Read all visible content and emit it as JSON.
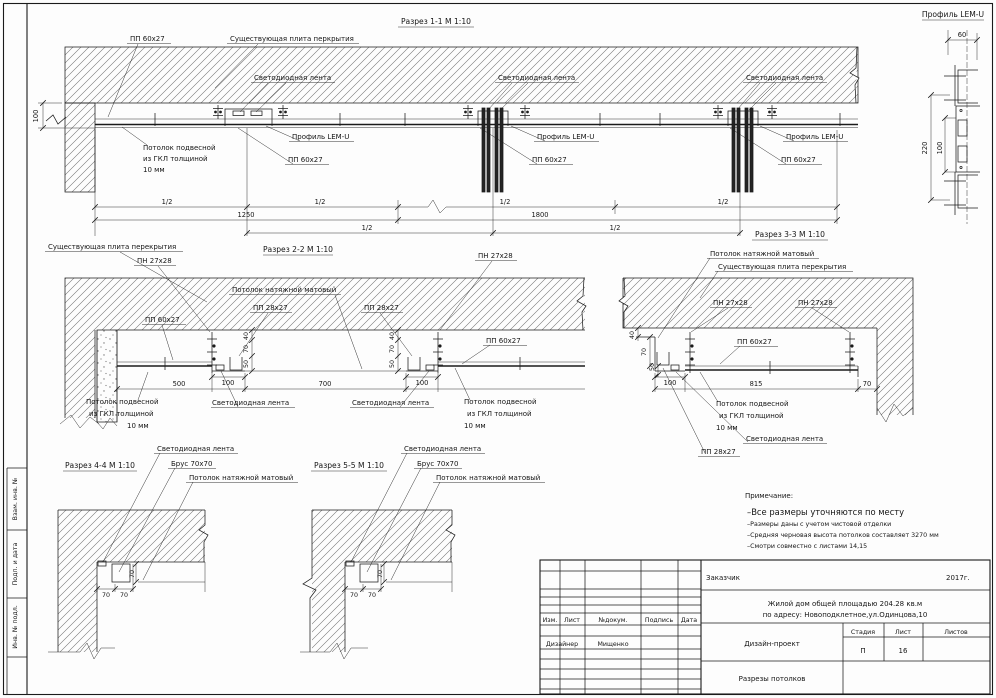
{
  "sheet": {
    "side_labels": [
      "Взам. инв. №",
      "Подп. и дата",
      "Инв. № подл."
    ]
  },
  "common": {
    "led": "Светодиодная лента",
    "lemu": "Профиль LEM-U",
    "pp60": "ПП 60х27",
    "pp28": "ПП 28х27",
    "pn27": "ПН 27х28",
    "slab": "Существующая плита перекрытия",
    "slab_s11": "Существующая плита перкрытия",
    "stretch": "Потолок натяжной матовый",
    "gkl1": "Потолок подвесной",
    "gkl2": "из ГКЛ толщиной",
    "gkl3": "10 мм",
    "brus": "Брус 70х70",
    "half": "1/2"
  },
  "sections": {
    "s11": {
      "title": "Разрез 1-1 М 1:10",
      "d100": "100",
      "d1250": "1250",
      "d1800": "1800"
    },
    "s22": {
      "title": "Разрез 2-2 М 1:10",
      "d40": "40",
      "d70": "70",
      "d50": "50",
      "d100": "100",
      "d500": "500",
      "d700": "700"
    },
    "s33": {
      "title": "Разрез 3-3 М 1:10",
      "d40": "40",
      "d70": "70",
      "d50": "50",
      "d100": "100",
      "d815": "815",
      "d70gap": "70"
    },
    "s44": {
      "title": "Разрез 4-4 М 1:10",
      "d70a": "70",
      "d70b": "70",
      "d70c": "70"
    },
    "s55": {
      "title": "Разрез 5-5 М 1:10",
      "d70a": "70",
      "d70b": "70",
      "d70c": "70"
    },
    "lemu": {
      "title": "Профиль LEM-U",
      "d60": "60",
      "d220": "220",
      "d100": "100"
    }
  },
  "notes": {
    "heading": "Примечание:",
    "line1": "–Все размеры уточняются по месту",
    "line2": "–Размеры даны с учетом чистовой отделки",
    "line3": "–Средняя черновая высота потолков составляет 3270 мм",
    "line4": "–Смотри совместно с листами 14,15"
  },
  "titleblock": {
    "customer_label": "Заказчик",
    "year": "2017г.",
    "object_line1": "Жилой дом общей площадью 204.28 кв.м",
    "object_line2": "по адресу: Новоподклетное,ул.Одинцова,10",
    "cols": {
      "izm": "Изм.",
      "list": "Лист",
      "doc": "№докум.",
      "sign": "Подпись",
      "date": "Дата"
    },
    "designer_label": "Дизайнер",
    "designer_name": "Мищенко",
    "project_type": "Дизайн-проект",
    "stage_label": "Стадия",
    "sheet_label": "Лист",
    "sheets_label": "Листов",
    "stage_value": "П",
    "sheet_value": "16",
    "doc_title": "Разрезы потолков"
  }
}
